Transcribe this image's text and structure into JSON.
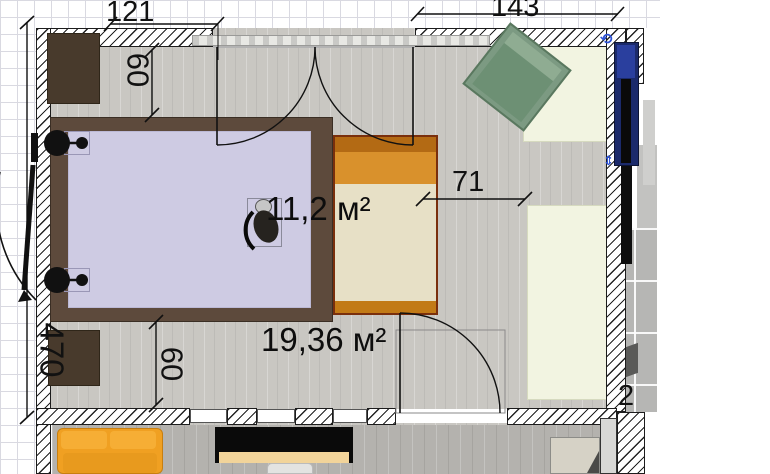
{
  "labels": {
    "room_small_area": "11,2 м²",
    "room_large_area": "19,36 м²",
    "dim_top_left": "121",
    "dim_top_right": "143",
    "dim_left_wall": "470",
    "dim_top_offset": "60",
    "dim_bottom_offset": "60",
    "dim_bed_to_rug": "71",
    "dim_partial_right": "2"
  },
  "icons": {
    "rotate_handle": "⟲",
    "resize_handle": "⇕"
  },
  "colors": {
    "floor_wood": "#c9c7c2",
    "mattress_lavender": "#cecbe3",
    "bed_frame_brown": "#5d4a3c",
    "single_bed_orange": "#d9912c",
    "single_bed_cream": "#e7e0c6",
    "armchair_green": "#7c9a82",
    "rug_cream": "#f2f4e1",
    "sofa_yellow": "#f0a022",
    "selected_navy": "#1b2a6b",
    "tile_gray": "#b6b6b4",
    "selection_blue": "#2c51d4"
  }
}
